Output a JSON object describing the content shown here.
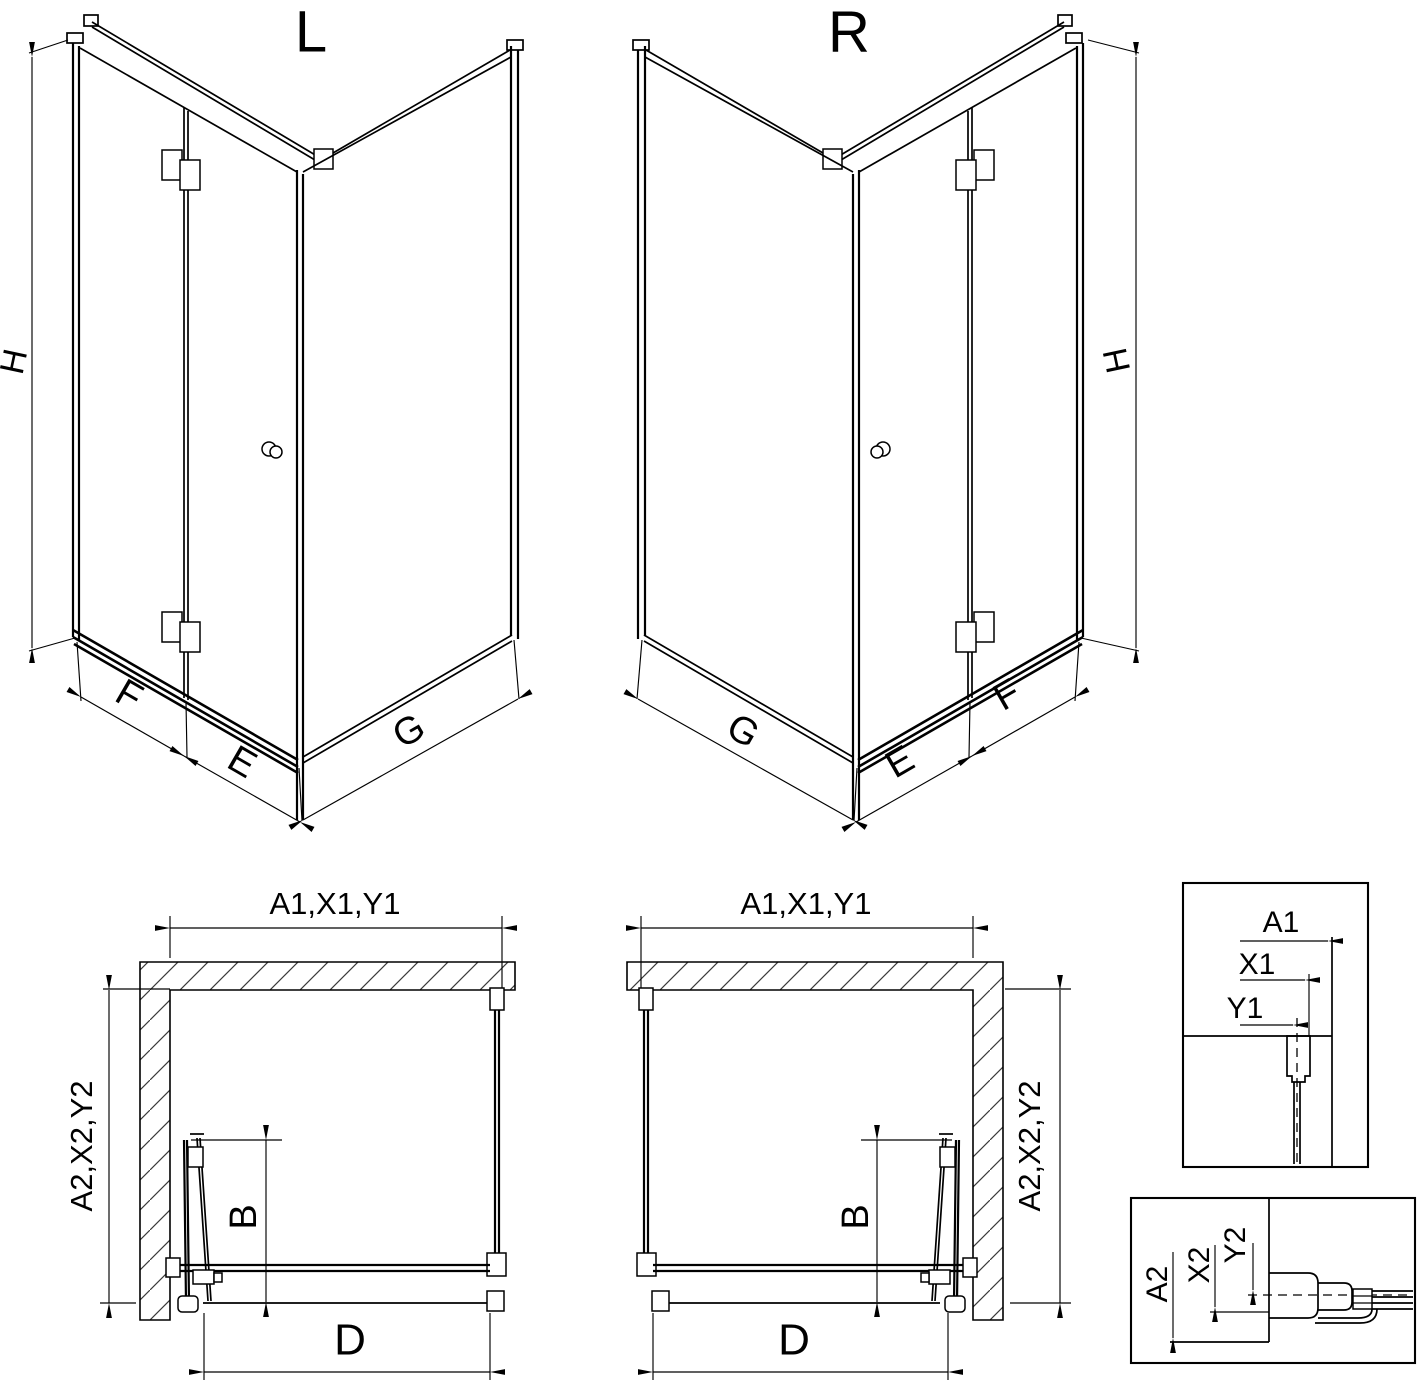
{
  "drawing": {
    "title_left_variant": "L",
    "title_right_variant": "R",
    "colors": {
      "line": "#000000",
      "background": "#ffffff"
    },
    "iso_left": {
      "label": "L",
      "dim_height": "H",
      "dim_f": "F",
      "dim_e": "E",
      "dim_g": "G"
    },
    "iso_right": {
      "label": "R",
      "dim_height": "H",
      "dim_f": "F",
      "dim_e": "E",
      "dim_g": "G"
    },
    "plan_left": {
      "dim_width_top": "A1,X1,Y1",
      "dim_depth_side": "A2,X2,Y2",
      "dim_door": "B",
      "dim_entry": "D"
    },
    "plan_right": {
      "dim_width_top": "A1,X1,Y1",
      "dim_depth_side": "A2,X2,Y2",
      "dim_door": "B",
      "dim_entry": "D"
    },
    "detail_top": {
      "dim_a": "A1",
      "dim_x": "X1",
      "dim_y": "Y1"
    },
    "detail_bottom": {
      "dim_a": "A2",
      "dim_x": "X2",
      "dim_y": "Y2"
    }
  }
}
